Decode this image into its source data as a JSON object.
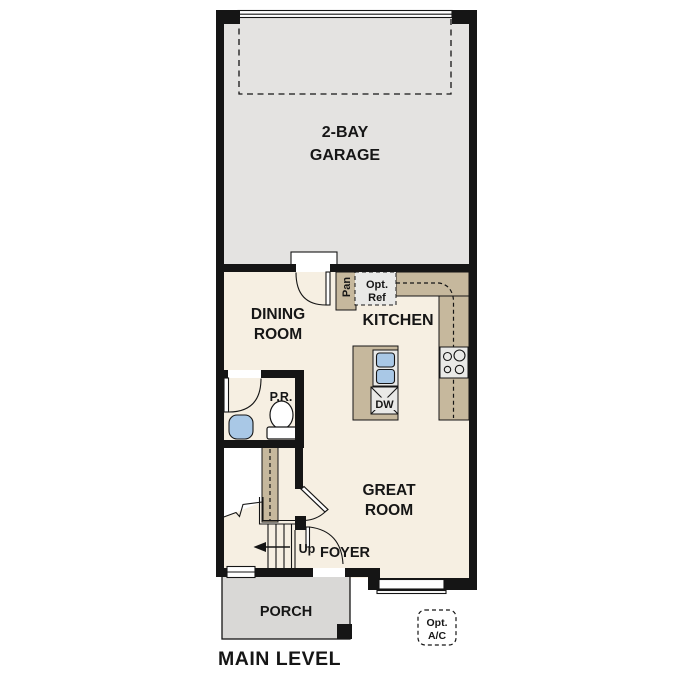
{
  "plan_title": "MAIN LEVEL",
  "colors": {
    "wall": "#151515",
    "floor": "#f6efe2",
    "garage": "#e4e3e1",
    "porch": "#d9d8d6",
    "counter": "#c6b89d",
    "sink": "#a9c8e6",
    "appliance": "#e9e9e7"
  },
  "rooms": {
    "garage": {
      "line1": "2-BAY",
      "line2": "GARAGE"
    },
    "dining": {
      "line1": "DINING",
      "line2": "ROOM"
    },
    "kitchen": {
      "label": "KITCHEN"
    },
    "great_room": {
      "line1": "GREAT",
      "line2": "ROOM"
    },
    "foyer": {
      "label": "FOYER"
    },
    "porch": {
      "label": "PORCH"
    },
    "powder_room": {
      "label": "P.R."
    }
  },
  "fixtures": {
    "pantry": "Pan",
    "opt_refrigerator": {
      "line1": "Opt.",
      "line2": "Ref"
    },
    "dishwasher": "DW",
    "stairs_direction": "Up",
    "opt_ac": {
      "line1": "Opt.",
      "line2": "A/C"
    }
  }
}
